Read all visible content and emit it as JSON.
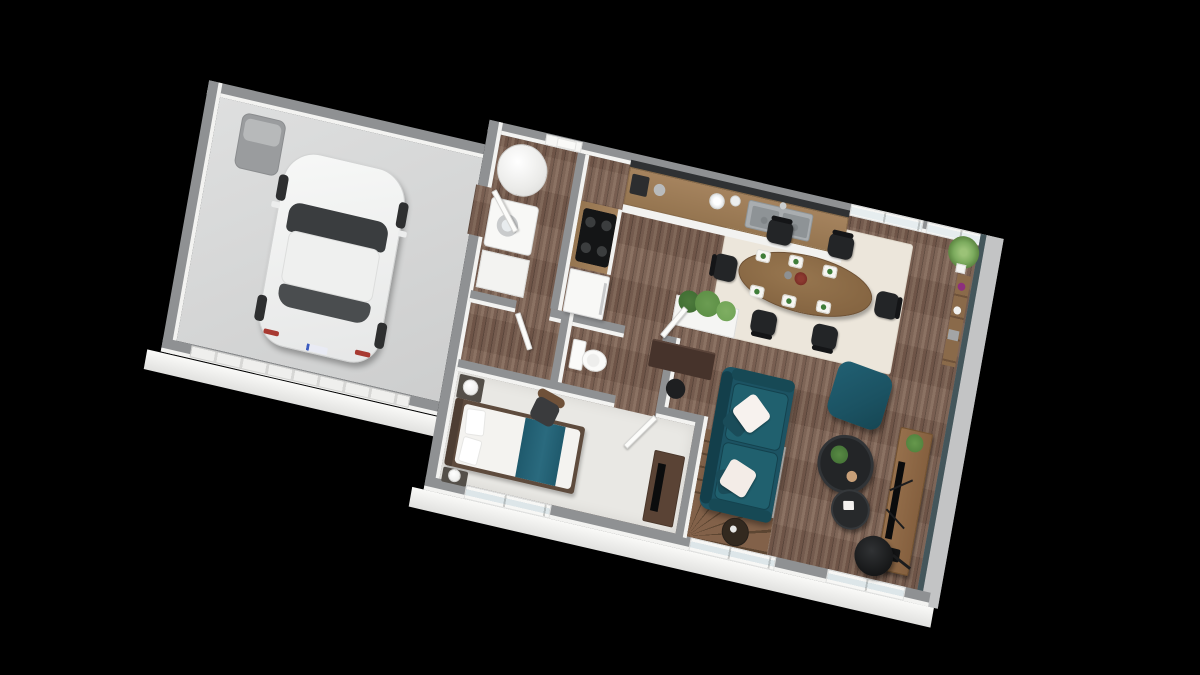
{
  "scene_type": "3d-floor-plan-render",
  "palette": {
    "bg": "#000000",
    "wallTop": "#8f9193",
    "wallFace": "#f3f3f1",
    "accentWall": "#44565b",
    "apron": "#c3c4c5",
    "plankGap": "#604b3f",
    "garageFloor": "#d6d7d7",
    "carpet": "#e9e8e4",
    "rug": "#ece6db",
    "teal": "#1c5363",
    "tealDark": "#133f4b",
    "tealLight": "#20606e",
    "furnitureWood": "#8a6443",
    "stairWood": "#7f6048",
    "chairBlack": "#232527",
    "applianceWhite": "#f8f8f6",
    "backsplash": "#2f3133",
    "plantGreen": "#5a8c43"
  },
  "rooms": {
    "garage": {
      "name": "Garage",
      "items": [
        "white-car",
        "wheelie-bin",
        "garage-door"
      ]
    },
    "utility": {
      "name": "Utility room",
      "items": [
        "water-heater",
        "washing-machine",
        "cabinet",
        "entry-door"
      ]
    },
    "kitchen": {
      "name": "Kitchen",
      "items": [
        "counter-with-double-sink",
        "cooktop",
        "fridge",
        "coffee-machine",
        "dish-stack",
        "dark-backsplash"
      ]
    },
    "wc": {
      "name": "WC",
      "items": [
        "toilet"
      ]
    },
    "bedroom": {
      "name": "Bedroom",
      "items": [
        "double-bed-teal-runner",
        "nightstand-with-lamp",
        "second-nightstand-with-lamp",
        "armchair",
        "tv-dresser"
      ]
    },
    "stairs": {
      "name": "Winder staircase",
      "items": [
        "wood-treads"
      ]
    },
    "living_dining": {
      "name": "Living / dining room",
      "items": [
        "oval-dining-table",
        "six-black-chairs",
        "six-place-settings",
        "cream-rug",
        "planter-box",
        "writing-desk",
        "stool",
        "teal-sofa",
        "white-cushions",
        "teal-pouf",
        "round-coffee-table-large",
        "round-coffee-table-small",
        "side-table",
        "tv-sideboard",
        "television",
        "floor-lamp",
        "ladder-shelf",
        "corner-grass-plant"
      ]
    }
  },
  "openings": {
    "top_windows": 2,
    "bottom_windows": 3,
    "entry_door": 1,
    "garage_door": 1,
    "interior_door_leaves": 4
  }
}
